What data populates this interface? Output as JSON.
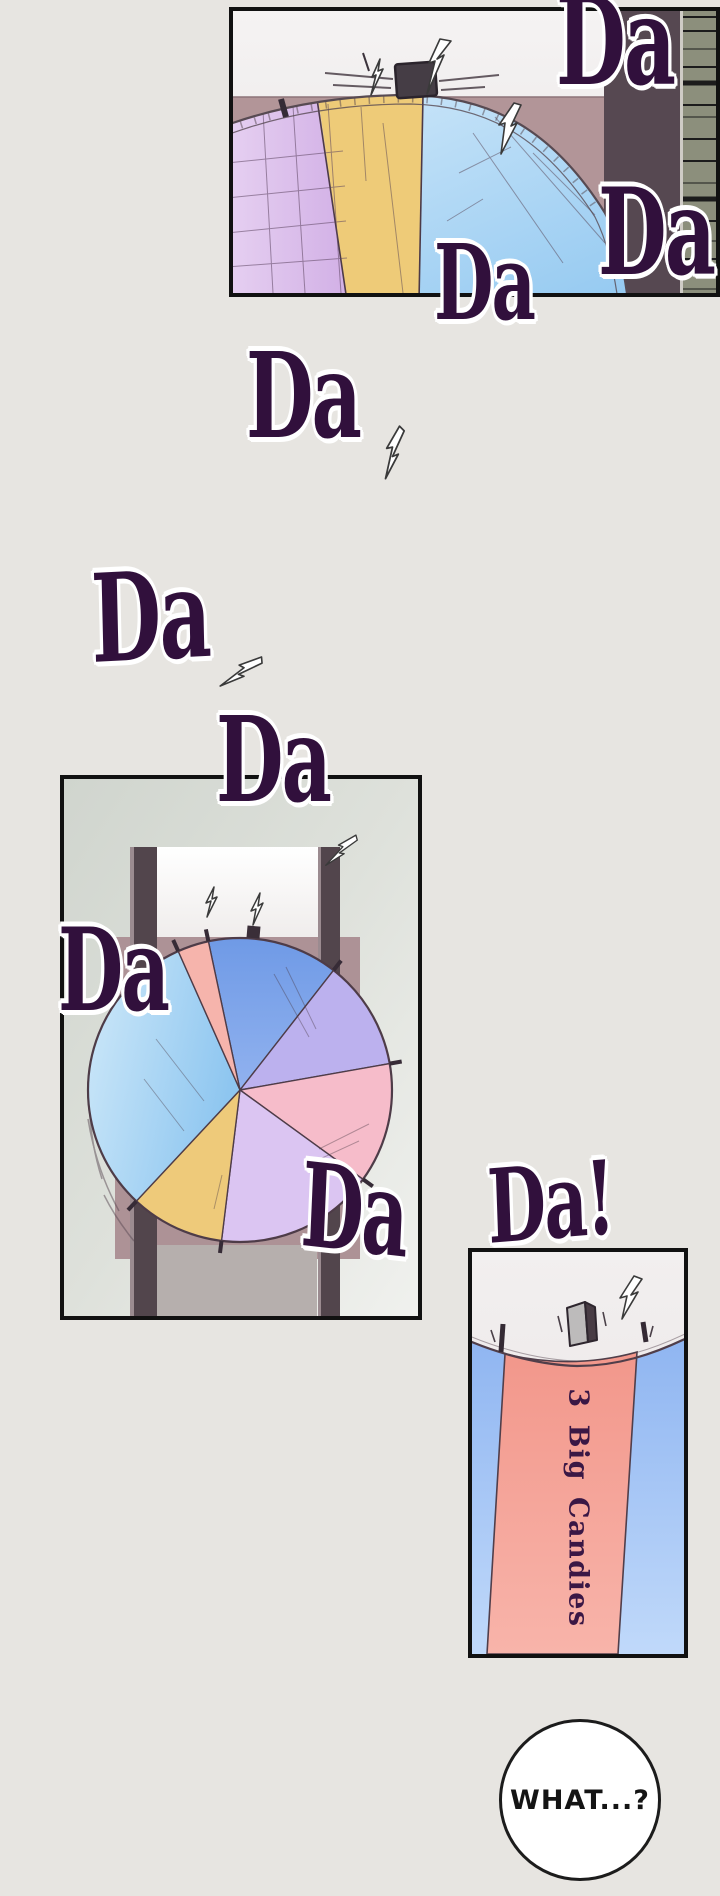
{
  "sfx": [
    {
      "text": "Da"
    },
    {
      "text": "Da"
    },
    {
      "text": "Da"
    },
    {
      "text": "Da"
    },
    {
      "text": "Da"
    },
    {
      "text": "Da"
    },
    {
      "text": "Da"
    },
    {
      "text": "Da"
    },
    {
      "text": "Da!"
    }
  ],
  "wheel_panel": {
    "prize_label": "3 Big Candies"
  },
  "speech": {
    "text": "WHAT...?"
  },
  "colors": {
    "page_bg": "#e7e5e1",
    "sfx_text": "#31103c",
    "sfx_outline": "#ffffff",
    "panel_border": "#111111",
    "wheel_segments": {
      "blue": "#7ba4ea",
      "lavender": "#bcb1ee",
      "pink": "#f6bcca",
      "lilac": "#dbc5f2",
      "yellow": "#eeca7a",
      "light_blue": "#9ccaf0",
      "salmon_sliver": "#f6b4ac"
    },
    "top_panel": {
      "backdrop_mauve": "#b29598",
      "wall_dark": "#564851",
      "wall_green": "#8c8f7c",
      "segment_purple": "#d6b5e8",
      "segment_yellow": "#eecb78",
      "segment_blue": "#aed7f4"
    },
    "closeup_panel": {
      "salmon": "#f2978b",
      "blue": "#8fb5f1",
      "label_text": "#3a1745",
      "pointer_gray": "#bdbbbb"
    },
    "speech_bubble": {
      "fill": "#ffffff",
      "border": "#1c1c1c",
      "text": "#141414"
    }
  }
}
